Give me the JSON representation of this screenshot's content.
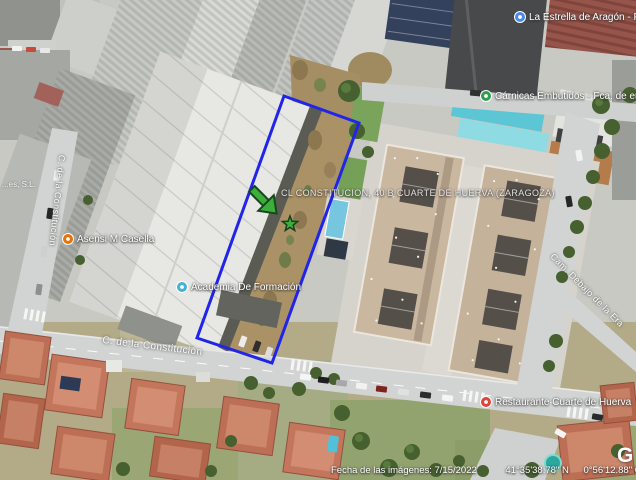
{
  "map": {
    "parcel_label": "CL CONSTITUCION, 40 B CUARTE DE HUERVA (ZARAGOZA)",
    "streets": {
      "main_road": "C. de la Constitución",
      "left_road": "C. de la Constitución",
      "right_road": "Cam. Debajo de la Era"
    },
    "partial_business_label": "...es, S.L.",
    "pois": [
      {
        "name": "La Estrella de Aragón - Famili",
        "color": "#4d87f2"
      },
      {
        "name": "Cárnicas Embutidos - Fca. de embutidos",
        "color": "#2f9e4f"
      },
      {
        "name": "Asensi M Casella",
        "color": "#e8710a"
      },
      {
        "name": "Academia De Formación",
        "color": "#45b1d4"
      },
      {
        "name": "Restaurante Cuarte de Huerva",
        "color": "#dc4537"
      }
    ],
    "annotations": {
      "parcel_outline_color": "#2125e8",
      "marker_color": "#3cae3c"
    },
    "attribution": {
      "imagery_date": "Fecha de las imágenes: 7/15/2022",
      "latitude": "41°35'38.78\" N",
      "longitude": "0°56'12.88\" O",
      "elevation_label": "elev",
      "elevation_value": "0 m",
      "watermark": "G"
    }
  }
}
